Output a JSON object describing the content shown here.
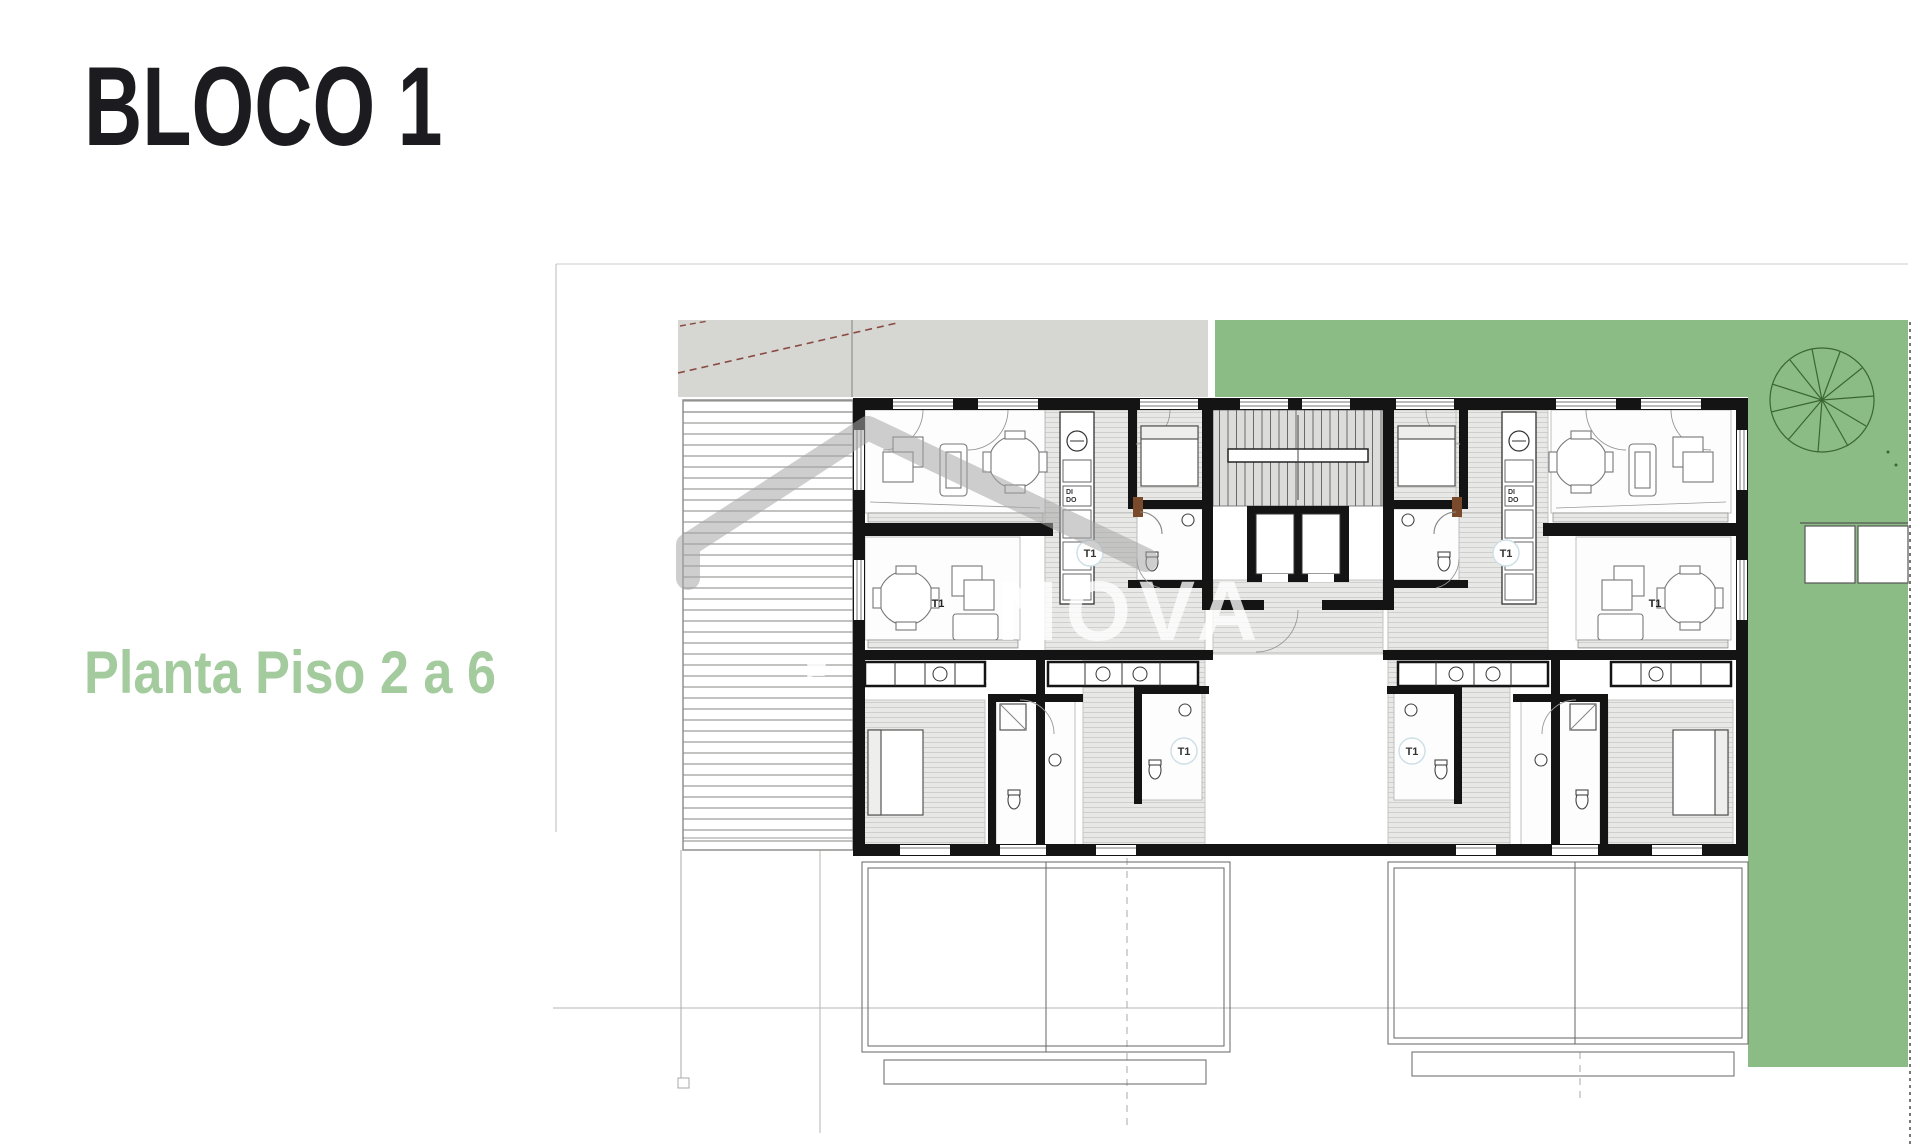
{
  "page": {
    "title": "BLOCO 1",
    "subtitle": "Planta Piso 2 a 6"
  },
  "colors": {
    "title_text": "#1b1b20",
    "subtitle_green": "#a3cb9e",
    "garden_green": "#8cbc86",
    "terrace_gray": "#d6d6d2",
    "wall_black": "#141414",
    "watermark_gray": "#a5a5a5"
  },
  "plan": {
    "unit_labels": [
      {
        "text": "T1",
        "style": "badge"
      },
      {
        "text": "T1",
        "style": "badge"
      },
      {
        "text": "T1",
        "style": "plain"
      },
      {
        "text": "T1",
        "style": "plain"
      },
      {
        "text": "T1",
        "style": "badge"
      },
      {
        "text": "T1",
        "style": "badge"
      }
    ],
    "kitchen_labels": [
      "DI",
      "DO"
    ],
    "watermark": {
      "main": "NOVA",
      "fragment_left": "E",
      "fragment_mid": "SA"
    }
  }
}
